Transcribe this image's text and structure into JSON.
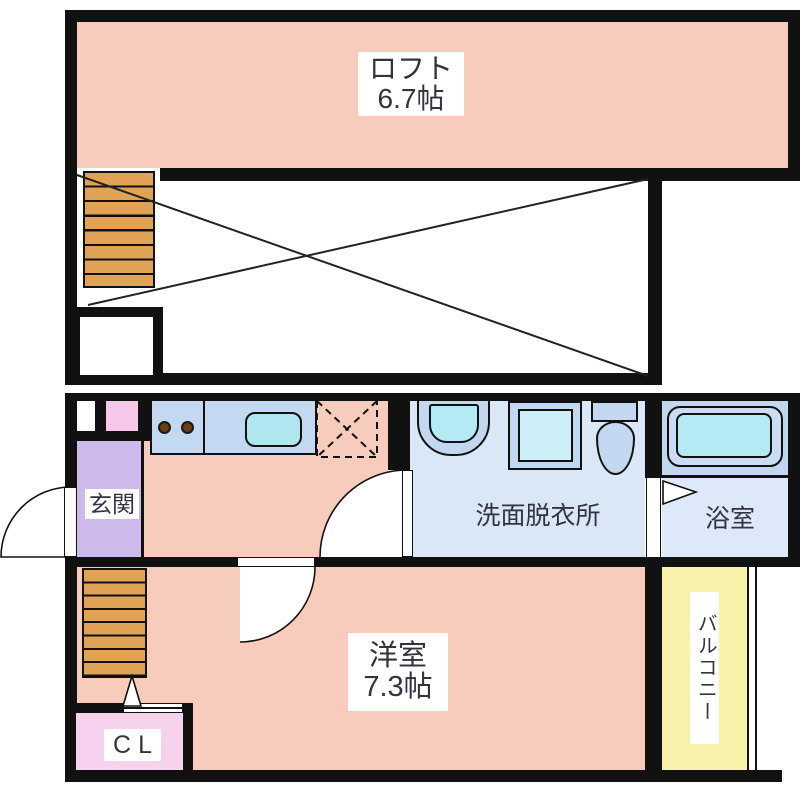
{
  "plan": {
    "loft_floor": {
      "loft": {
        "name": "ロフト",
        "size": "6.7帖"
      }
    },
    "first_floor": {
      "entrance": "玄関",
      "washroom": "洗面脱衣所",
      "bathroom": "浴室",
      "main_room": {
        "name": "洋室",
        "size": "7.3帖"
      },
      "closet": "CL",
      "balcony": "バルコニー"
    },
    "colors": {
      "room_salmon": "#F8CCBC",
      "stairs_orange": "#E0A355",
      "entrance_purple": "#CDBAEB",
      "closet_pink": "#F6D2EF",
      "cabinet_pink": "#F8C8EA",
      "counter_blue": "#C3D9F2",
      "sink_cyan": "#AFE6F0",
      "wet_floor_blue": "#D9E7F6",
      "fixture_blue": "#C3D8F0",
      "fixture_inner_cyan": "#B5E9F3",
      "balcony_yellow": "#F8F2AA",
      "wall_black": "#111111"
    }
  }
}
